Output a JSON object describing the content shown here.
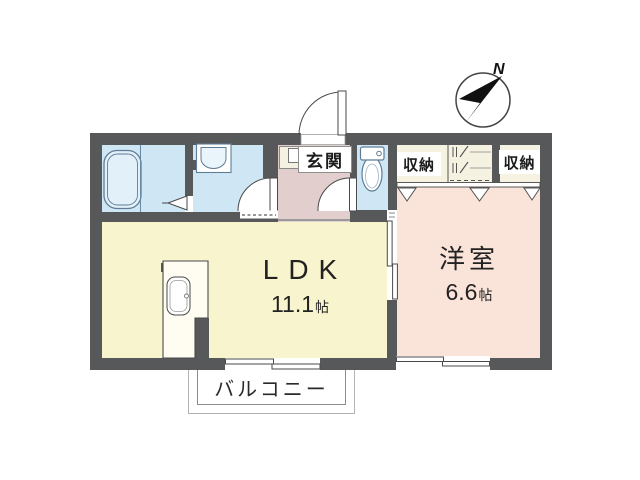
{
  "compass": {
    "label": "N"
  },
  "rooms": {
    "genkan": {
      "label": "玄関"
    },
    "storage_left": {
      "label": "収納"
    },
    "storage_right": {
      "label": "収納"
    },
    "western": {
      "label": "洋室",
      "size_value": "6.6",
      "size_unit": "帖"
    },
    "ldk": {
      "label": "LDK",
      "size_value": "11.1",
      "size_unit": "帖"
    },
    "balcony": {
      "label": "バルコニー"
    }
  },
  "colors": {
    "wall": "#57585a",
    "wet_room": "#cfe7f5",
    "hallway": "#e2cecd",
    "ldk": "#f8f4cd",
    "western_room": "#fae4da",
    "storage": "#f5f2e1"
  }
}
